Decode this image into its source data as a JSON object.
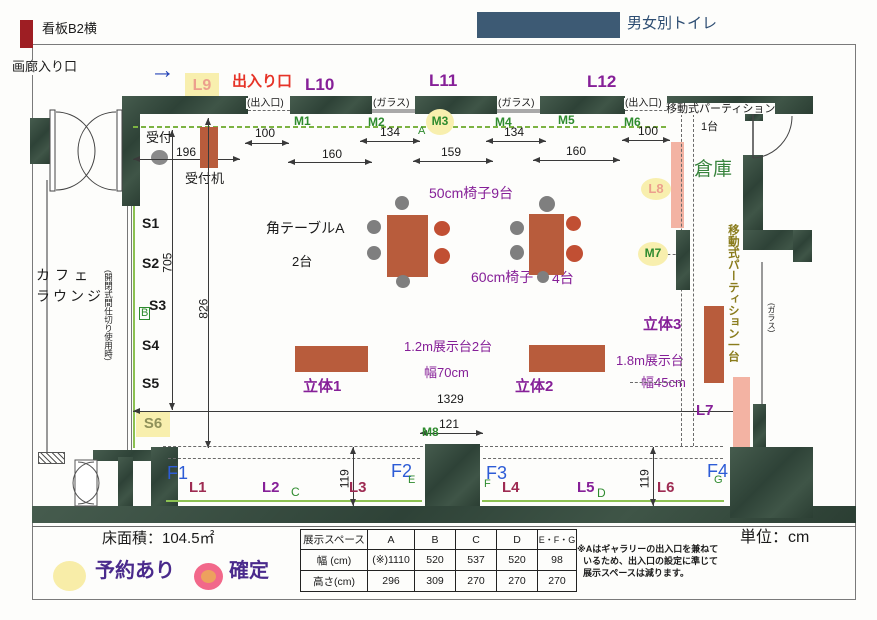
{
  "page": {
    "sign_b2": "看板B2横",
    "gallery_entrance": "画廊入り口",
    "toilet": "男女別トイレ",
    "entrance_exit_red": "出入り口",
    "floor_area": "床面積：104.5㎡",
    "unit": "単位：cm",
    "legend_reserved": "予約あり",
    "legend_confirmed": "確定",
    "note_lines": [
      "※Aはギャラリーの出入口を兼ねて",
      "いるため、出入口の設定に準じて",
      "展示スペースは減ります。"
    ],
    "arrow_glyph": "→"
  },
  "areas": {
    "storage": "倉庫",
    "cafe_l1": "カフェ",
    "cafe_l2": "ラウンジ",
    "reception": "受付",
    "reception_desk": "受付机",
    "mobile_partition": "移動式パーティション",
    "mobile_partition_count": "1台",
    "mobile_partition_vertical": "移動式パーティション一台",
    "partition_usage_note": "(開閉式間仕切り使用時)",
    "gap_entrance1": "(出入口)",
    "gap_glass1": "(ガラス)",
    "gap_glass2": "(ガラス)",
    "gap_entrance2": "(出入口)",
    "glass_side": "(ガラス)"
  },
  "labels": {
    "l1": "L1",
    "l2": "L2",
    "l3": "L3",
    "l4": "L4",
    "l5": "L5",
    "l6": "L6",
    "l7": "L7",
    "l8": "L8",
    "l9": "L9",
    "l10": "L10",
    "l11": "L11",
    "l12": "L12",
    "m1": "M1",
    "m2": "M2",
    "m3": "M3",
    "m4": "M4",
    "m5": "M5",
    "m6": "M6",
    "m7": "M7",
    "m8": "M8",
    "s1": "S1",
    "s2": "S2",
    "s3": "S3",
    "s4": "S4",
    "s5": "S5",
    "s6": "S6",
    "f1": "F1",
    "f2": "F2",
    "f3": "F3",
    "f4": "F4",
    "zone_a": "A",
    "zone_b": "B",
    "zone_c": "C",
    "zone_d": "D",
    "zone_e": "E",
    "zone_f": "F",
    "zone_g": "G"
  },
  "furniture": {
    "table_a": "角テーブルA",
    "table_a_count": "2台",
    "chairs_50": "50cm椅子9台",
    "chairs_60": "60cm椅子",
    "chairs_60_count": "4台",
    "rittai1": "立体1",
    "rittai2": "立体2",
    "rittai3": "立体3",
    "stand_12m": "1.2m展示台2台",
    "stand_12m_width": "幅70cm",
    "stand_18m": "1.8m展示台",
    "stand_18m_width": "幅45cm"
  },
  "dims": {
    "w196": "196",
    "w100a": "100",
    "w134a": "134",
    "w134b": "134",
    "w100b": "100",
    "w160a": "160",
    "w159": "159",
    "w160b": "160",
    "h705": "705",
    "h826": "826",
    "w1329": "1329",
    "w121": "121",
    "h119a": "119",
    "h119b": "119"
  },
  "spec_table": {
    "headers": [
      "展示スペース",
      "A",
      "B",
      "C",
      "D",
      "E・F・G"
    ],
    "row_width_label": "幅 (cm)",
    "row_width": [
      "(※)1110",
      "520",
      "537",
      "520",
      "98"
    ],
    "row_height_label": "高さ(cm)",
    "row_height": [
      "296",
      "309",
      "270",
      "270",
      "270"
    ]
  },
  "colors": {
    "wall": "#3c5246",
    "stand_red": "#b85c3c",
    "pink": "#f3b3a3",
    "highlight": "#f8efae",
    "purple": "#862098",
    "dark_red": "#9e2b52",
    "blue": "#2d5cd6",
    "green": "#2e8b2e",
    "toilet_blue": "#3d5a74",
    "legend_purple": "#4a2a8c",
    "salmon": "#ec9f8d",
    "olive": "#8a7c1c"
  }
}
